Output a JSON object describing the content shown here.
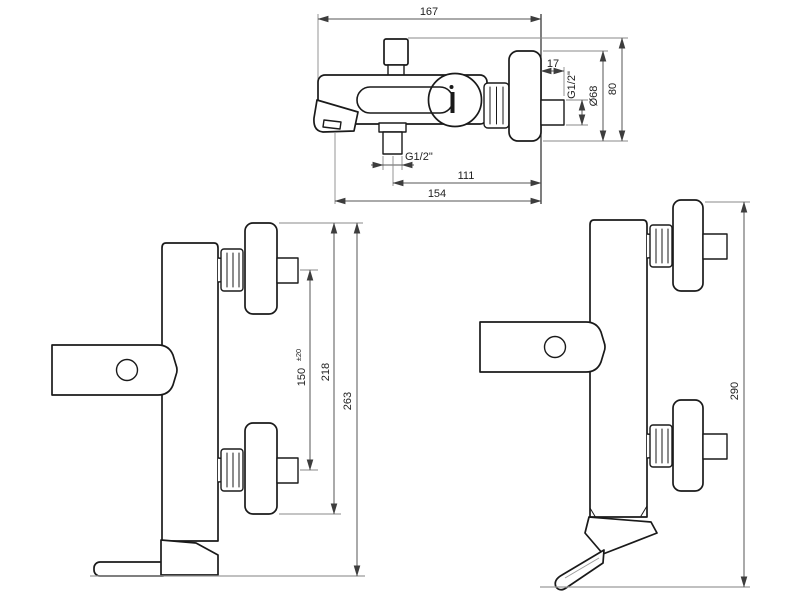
{
  "diagram": {
    "type": "technical-drawing",
    "subject": "Wall-mounted single-lever bath/shower mixer — dimensioned orthographic views",
    "units": "mm",
    "colors": {
      "outline": "#1a1a1a",
      "dimension_line": "#555555",
      "extension_line": "#8a8a8a",
      "label_text": "#1f1f1f",
      "background": "#ffffff"
    },
    "views": {
      "side": {
        "name": "Side view",
        "dims": {
          "overall_depth": "167",
          "stub_length": "17",
          "inlet_thread": "G1/2\"",
          "escutcheon_diameter": "Ø68",
          "body_height": "80",
          "outlet_thread": "G1/2\"",
          "outlet_to_wall": "111",
          "spout_to_wall": "154"
        }
      },
      "front_bath": {
        "name": "Front view with straight spout",
        "dims": {
          "inlet_centres": "150",
          "inlet_centres_tolerance": "±20",
          "escutcheon_span": "218",
          "overall_height": "263"
        }
      },
      "front_shower": {
        "name": "Front view with angled spout",
        "dims": {
          "overall_height": "290"
        }
      }
    }
  }
}
